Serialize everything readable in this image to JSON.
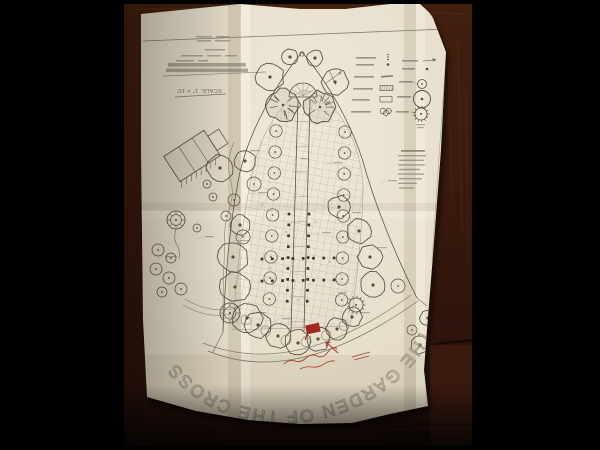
{
  "plan": {
    "arc_title": "THE GARDEN OF THE CROSS",
    "scale_note": "SCALE: 1\" = 10'",
    "title_block": {
      "legibility": "illegible small print, upside-down",
      "line_count": 9
    },
    "legend_left": {
      "row_count": 6,
      "symbols": [
        "dot-cluster",
        "dot",
        "dash",
        "hatched-bar",
        "rectangle",
        "shrub-cluster"
      ]
    },
    "legend_right": {
      "row_count": 5,
      "symbols": [
        "arrow",
        "dot",
        "small-tree-circle",
        "large-tree-circle",
        "spiky-evergreen-circle"
      ]
    },
    "plant_list": {
      "legibility": "illegible",
      "line_count": 8
    },
    "annotations": {
      "red_flag_marker": true,
      "red_handwriting": "illegible cursive",
      "red_arrow": true,
      "red_dashes": 2
    }
  },
  "colors": {
    "background": "#000000",
    "table_wood": "#3a1b0f",
    "table_wood_light": "#52291a",
    "paper": "#e9e2d0",
    "paper_shadowed": "#d6cdb6",
    "ink": "#564f3e",
    "ink_light": "#7a7261",
    "pencil_title": "#9b9280",
    "annotation_red": "#a5281f"
  }
}
